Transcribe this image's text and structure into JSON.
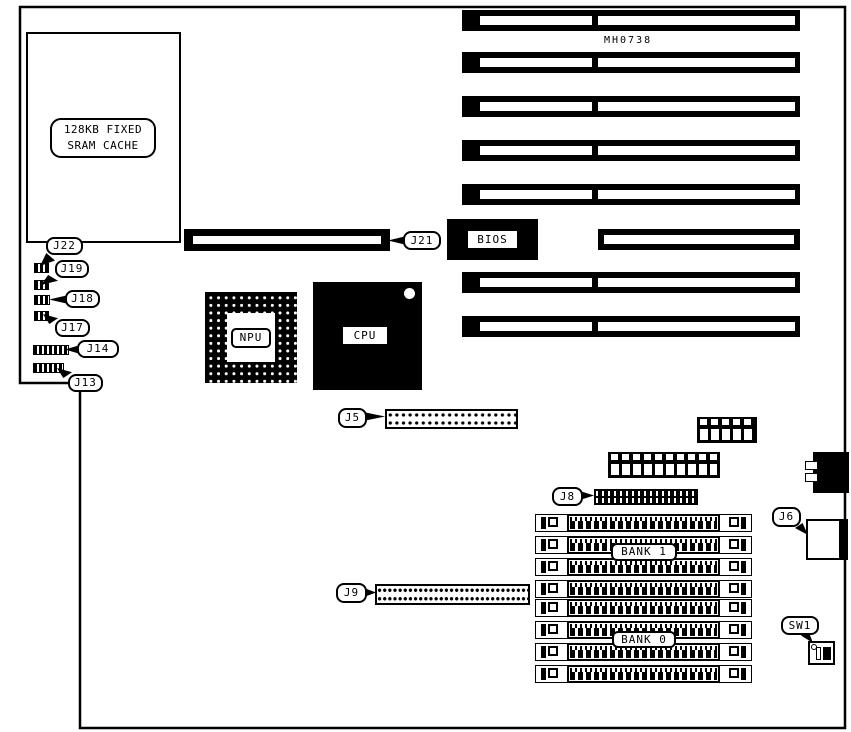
{
  "colors": {
    "ink": "#000000",
    "paper": "#ffffff"
  },
  "board": {
    "part_number": "MH0738",
    "sram": {
      "line1": "128KB FIXED",
      "line2": "SRAM CACHE"
    },
    "chips": {
      "npu": "NPU",
      "cpu": "CPU",
      "bios": "BIOS"
    },
    "memory": {
      "bank1": "BANK 1",
      "bank0": "BANK 0"
    },
    "callouts": {
      "j22": "J22",
      "j19": "J19",
      "j18": "J18",
      "j17": "J17",
      "j14": "J14",
      "j13": "J13",
      "j21": "J21",
      "j5": "J5",
      "j8": "J8",
      "j9": "J9",
      "j6": "J6",
      "sw1": "SW1"
    }
  }
}
